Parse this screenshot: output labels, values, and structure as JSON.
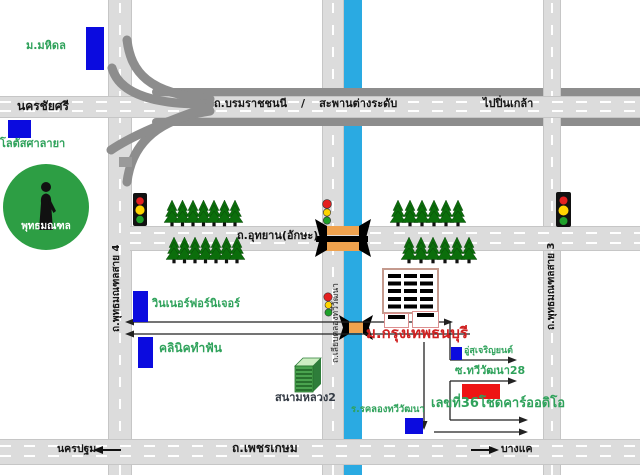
{
  "map": {
    "roads": {
      "nakhon_chai_si": "นครชัยศรี",
      "borommaratchachonnani": "ถ.บรมราชชนนี",
      "separator": "/",
      "flyover": "สะพานต่างระดับ",
      "to_pin_klao": "ไปปิ่นเกล้า",
      "utthayan": "ถ.อุทยาน(อักษะ)",
      "phutthamonthon_sai4": "ถ.พุทธมณฑลสาย 4",
      "phutthamonthon_sai3": "ถ.พุทธมณฑลสาย 3",
      "liap_khlong_thawi_watthana": "ถ.เลียบคลองทวีวัฒนา",
      "phet_kasem": "ถ.เพชรเกษม",
      "to_nakhon_pathom": "นครปฐม",
      "to_bang_khae": "บางแค",
      "soi_thawi_watthana_28": "ซ.ทวีวัฒนา28"
    },
    "places": {
      "mahidol_university": "ม.มหิดล",
      "lotus_salaya": "โลตัสศาลายา",
      "phutthamonthon_park": "พุทธมณฑล",
      "winner_furniture": "วินเนอร์ฟอร์นิเจอร์",
      "dental_clinic": "คลินิคทำฟัน",
      "sanam_luang_2": "สนามหลวง2",
      "bangkok_thonburi_university": "ม.กรุงเทพธนบุรี",
      "garage": "อู่สุเจริญยนต์",
      "car_audio_no36": "เลขที่36โชดคาร์ออดิโอ",
      "khlong_thawi_watthana_school": "ร.รคลองทวีวัฒนา"
    },
    "colors": {
      "canal_blue": "#2aaae2",
      "road_gray": "#dcdcdc",
      "elevated_road_gray": "#8d8d8d",
      "building_blue": "#0b0bdf",
      "highlight_red": "#ee1414",
      "bridge_orange": "#efa24e",
      "tree_green": "#0b6e0b",
      "park_green": "#2d9e44",
      "label_green": "#2fa25b",
      "university_label_red": "#d02020"
    }
  }
}
